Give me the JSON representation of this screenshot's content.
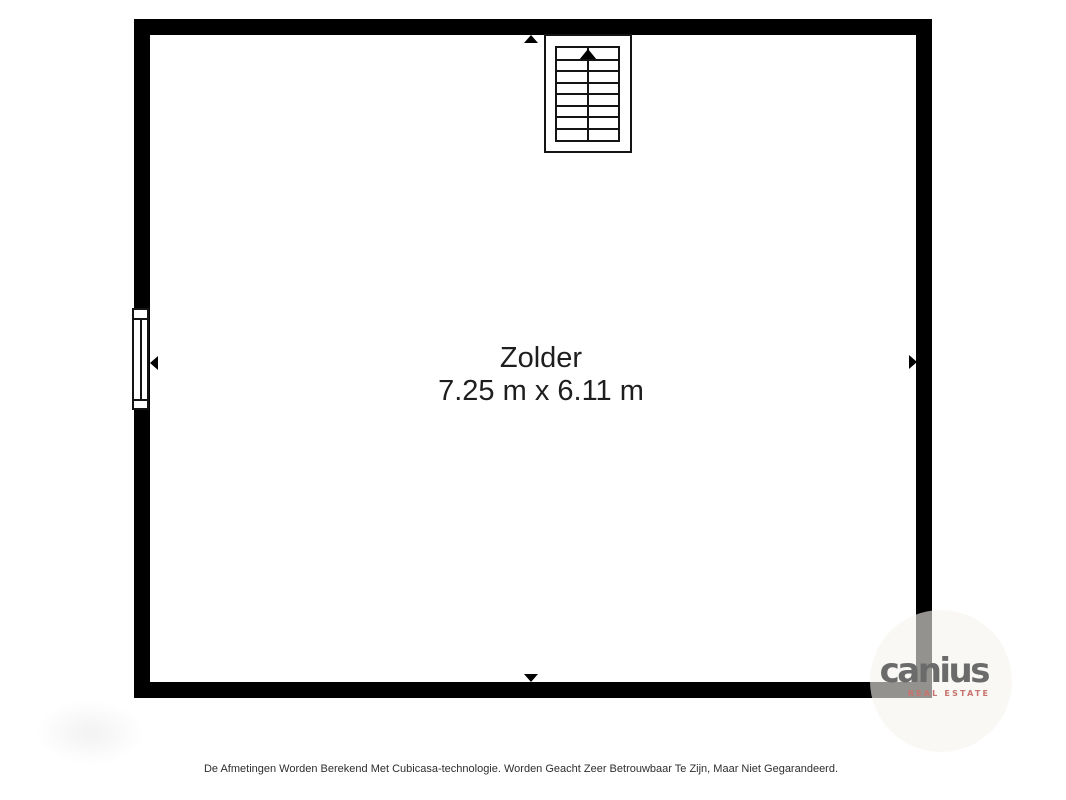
{
  "floorplan": {
    "room": {
      "name": "Zolder",
      "dimensions": "7.25 m x 6.11 m"
    },
    "stairs": {
      "steps": 8,
      "direction_icon": "triangle-up"
    },
    "window": {
      "wall": "left"
    },
    "wall_markers": {
      "top_icon": "triangle-up",
      "bottom_icon": "triangle-down",
      "left_icon": "triangle-left",
      "right_icon": "triangle-right"
    },
    "colors": {
      "wall": "#000000",
      "floor": "#ffffff",
      "line": "#141414",
      "label_text": "#1e1e1e"
    }
  },
  "watermark": {
    "brand": "canius",
    "tagline": "REAL ESTATE",
    "brand_color": "#6b6b6b",
    "tagline_color": "#c8736d",
    "circle_color": "#f5f3ef"
  },
  "footer": {
    "disclaimer": "De Afmetingen Worden Berekend Met Cubicasa-technologie. Worden Geacht Zeer Betrouwbaar Te Zijn, Maar Niet Gegarandeerd."
  }
}
